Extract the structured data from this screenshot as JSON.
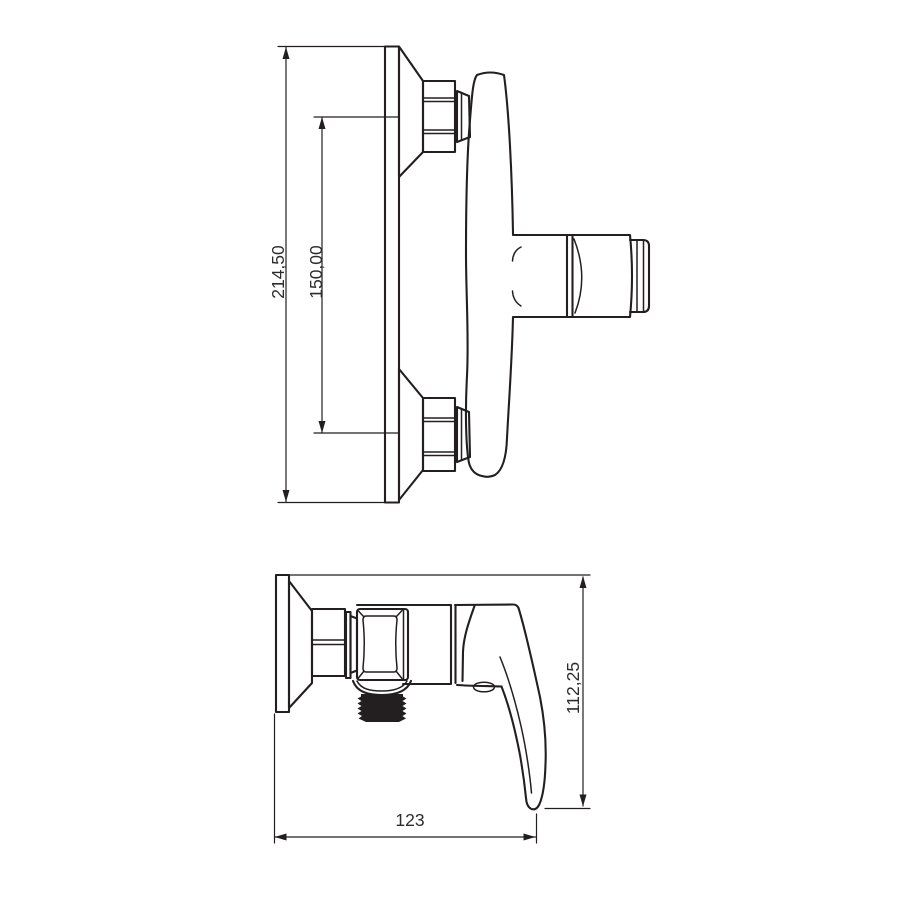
{
  "drawing": {
    "kind": "technical-dimension-drawing",
    "subject": "wall-mounted shower mixer valve, two orthographic views",
    "background_color": "#ffffff",
    "line_color": "#231f20",
    "views": [
      {
        "id": "front-elevation",
        "dims": {
          "overall_height": "214,50",
          "connection_spacing": "150,00"
        }
      },
      {
        "id": "side-elevation",
        "dims": {
          "height": "112,25",
          "depth": "123"
        }
      }
    ]
  }
}
